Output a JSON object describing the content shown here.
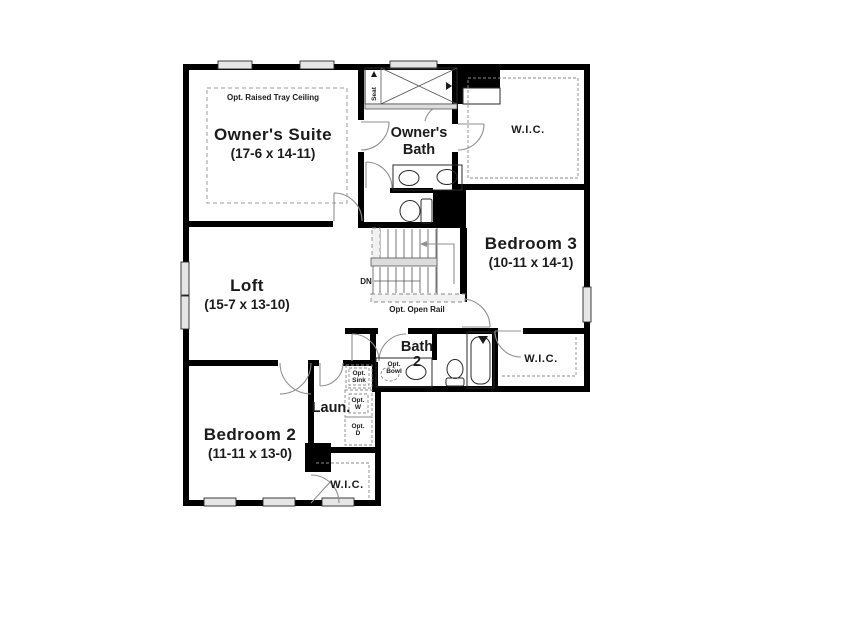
{
  "rooms": {
    "owners_suite": {
      "name": "Owner's Suite",
      "dims": "(17-6 x 14-11)",
      "tray_option": "Opt. Raised Tray Ceiling"
    },
    "owners_bath": {
      "name_line1": "Owner's",
      "name_line2": "Bath",
      "shower_seat": "Seat"
    },
    "wic_owner": {
      "name": "W.I.C."
    },
    "bedroom3": {
      "name": "Bedroom 3",
      "dims": "(10-11 x 14-1)"
    },
    "loft": {
      "name": "Loft",
      "dims": "(15-7 x 13-10)"
    },
    "stairs": {
      "down_label": "DN",
      "rail_option": "Opt. Open Rail"
    },
    "bath2": {
      "name_line1": "Bath",
      "name_line2": "2",
      "opt_bowl_line1": "Opt.",
      "opt_bowl_line2": "Bowl"
    },
    "wic_bedroom3": {
      "name": "W.I.C."
    },
    "laundry": {
      "name": "Laun.",
      "opt_sink_line1": "Opt.",
      "opt_sink_line2": "Sink",
      "opt_washer_line1": "Opt.",
      "opt_washer_line2": "W",
      "opt_dryer_line1": "Opt.",
      "opt_dryer_line2": "D"
    },
    "bedroom2": {
      "name": "Bedroom 2",
      "dims": "(11-11 x 13-0)"
    },
    "wic_bedroom2": {
      "name": "W.I.C."
    }
  },
  "colors": {
    "wall": "#000000",
    "text": "#1b1b1b",
    "door_arc": "#8f8f8f",
    "window_fill": "#e6e6e6",
    "background": "#ffffff"
  }
}
